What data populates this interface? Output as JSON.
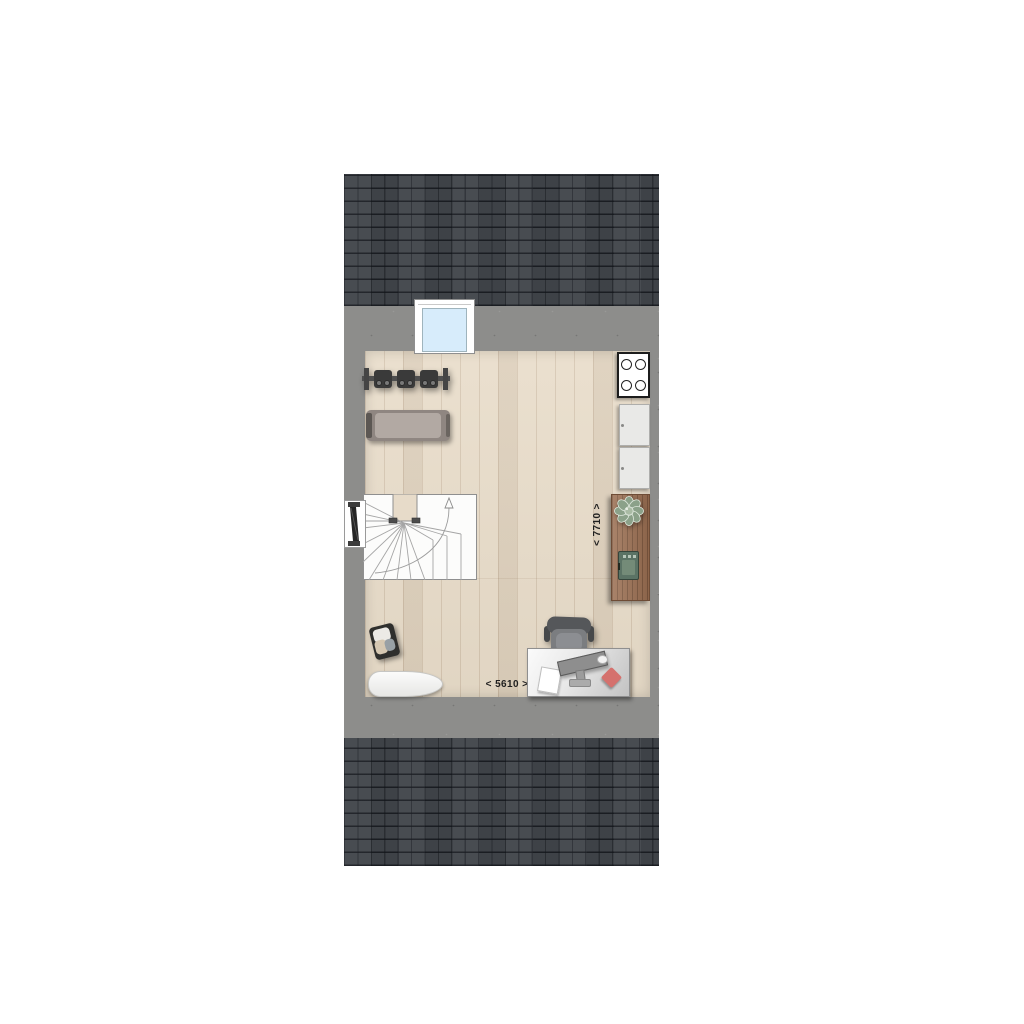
{
  "floorplan": {
    "dimension_depth_label": "< 7710 >",
    "dimension_width_label": "< 5610 >",
    "colors": {
      "roof_tile": "#41454b",
      "roof_grout": "#23262b",
      "concrete_wall": "#8d8d8b",
      "wood_floor": "#e8dcc9",
      "window_glass": "#d7ecfb",
      "sideboard_wood": "#9b6f52",
      "plant_green": "#8ba189",
      "device_green": "#5b7365",
      "accent_red": "#d5716d",
      "desk_gray": "#e8e8e8",
      "chair_gray": "#55575a"
    },
    "icons": [
      "roof-tiles",
      "window",
      "stove-burners",
      "kitchen-cabinet",
      "sideboard",
      "plant",
      "green-device",
      "winder-stairs",
      "up-arrow",
      "wall-door",
      "coat-rack",
      "bench",
      "laundry-basket",
      "ironing-board",
      "office-chair",
      "desk",
      "monitor",
      "paper-sheet",
      "mouse",
      "red-notepad"
    ]
  }
}
